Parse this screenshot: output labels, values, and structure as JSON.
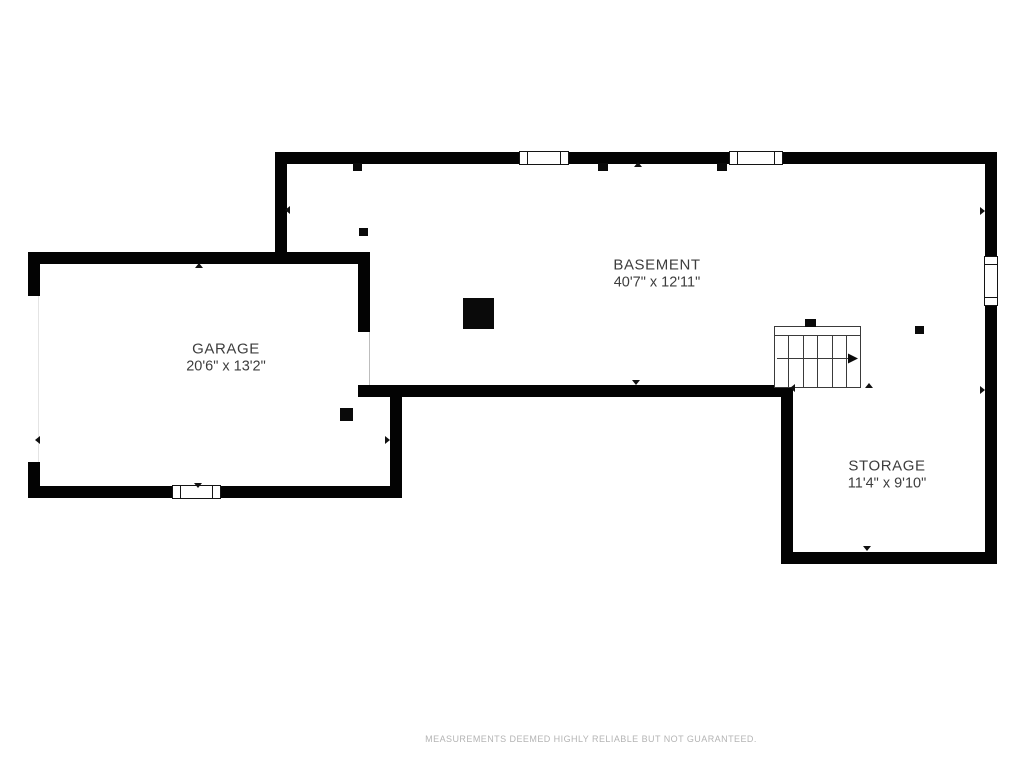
{
  "plan": {
    "background": "#ffffff",
    "wall_color": "#030303",
    "label_color": "#3d3d3d",
    "rooms": {
      "basement": {
        "name": "BASEMENT",
        "dimensions": "40'7\" x 12'11\""
      },
      "garage": {
        "name": "GARAGE",
        "dimensions": "20'6\" x 13'2\""
      },
      "storage": {
        "name": "STORAGE",
        "dimensions": "11'4\" x 9'10\""
      }
    },
    "symbols": {
      "stairs": "staircase-with-direction-arrow",
      "window": "double-line-window",
      "post": "solid-black-column"
    }
  },
  "footer": {
    "disclaimer": "MEASUREMENTS DEEMED HIGHLY RELIABLE BUT NOT GUARANTEED.",
    "color": "#b4b4b4"
  }
}
